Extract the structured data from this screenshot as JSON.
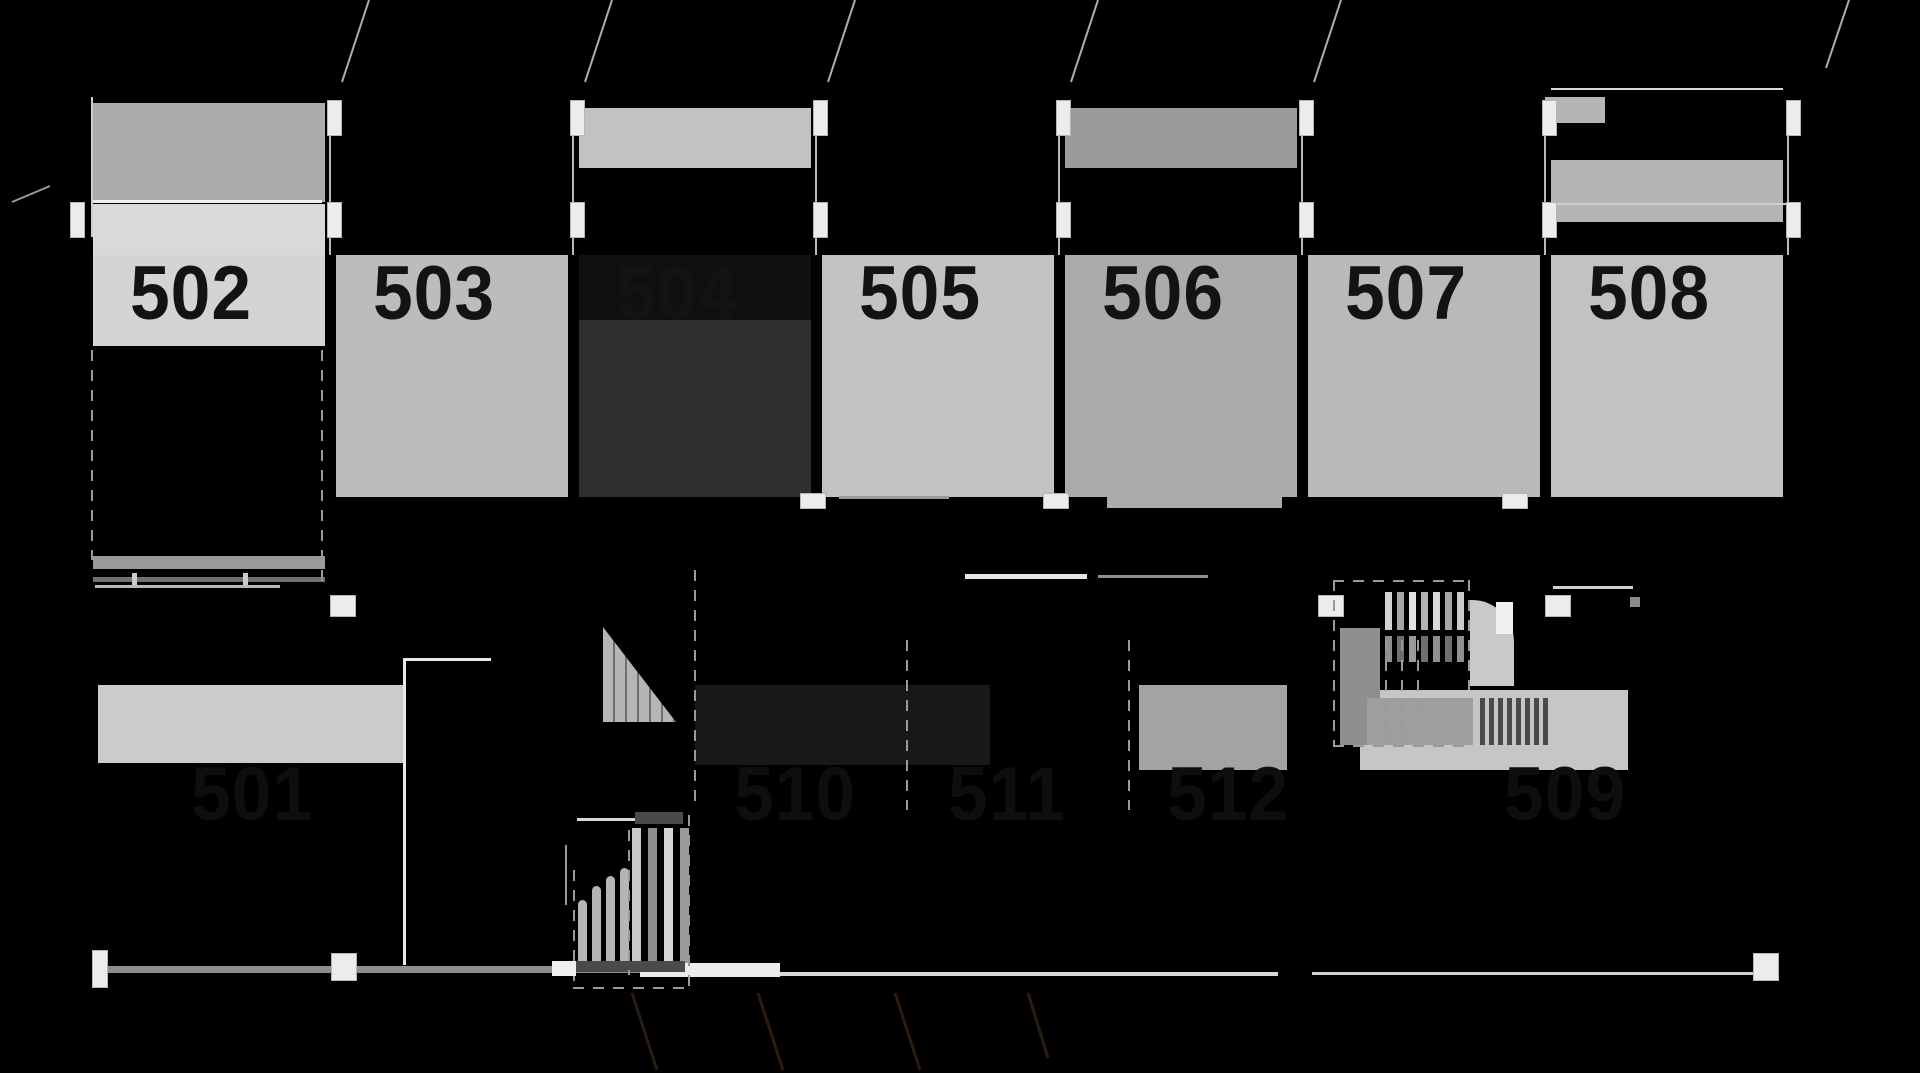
{
  "drawing": {
    "kind": "dark-background architectural floor plan with numbered rooms and stairs",
    "background": "#000000",
    "number_color_top": "#131313",
    "number_color_bottom": "#0e0e0e",
    "room_width": 232,
    "top_number_y": 256,
    "bottom_number_y": 757
  },
  "top_rooms": [
    {
      "number": "502",
      "x": 93,
      "rects": [
        {
          "y": 103,
          "h": 99,
          "c": "#ababab"
        },
        {
          "y": 204,
          "h": 51,
          "c": "#d9d9d9"
        },
        {
          "y": 255,
          "h": 91,
          "c": "#d4d4d4"
        }
      ],
      "dashed_lower": true,
      "bars": [
        {
          "y": 556,
          "h": 13,
          "c": "#9a9a9a"
        },
        {
          "y": 577,
          "h": 5,
          "c": "#707070"
        }
      ]
    },
    {
      "number": "503",
      "x": 336,
      "rects": [
        {
          "y": 255,
          "h": 242,
          "c": "#bcbcbc"
        }
      ]
    },
    {
      "number": "504",
      "x": 579,
      "rects": [
        {
          "y": 108,
          "h": 60,
          "c": "#c2c2c2"
        },
        {
          "y": 255,
          "h": 65,
          "c": "#101010"
        },
        {
          "y": 320,
          "h": 177,
          "c": "#2f2f2f"
        }
      ]
    },
    {
      "number": "505",
      "x": 822,
      "rects": [
        {
          "y": 255,
          "h": 242,
          "c": "#c3c3c3"
        }
      ]
    },
    {
      "number": "506",
      "x": 1065,
      "rects": [
        {
          "y": 108,
          "h": 60,
          "c": "#9b9b9b"
        },
        {
          "y": 255,
          "h": 242,
          "c": "#ababab"
        },
        {
          "dx": 42,
          "y": 497,
          "w": 175,
          "h": 11,
          "c": "#ababab"
        }
      ]
    },
    {
      "number": "507",
      "x": 1308,
      "rects": [
        {
          "y": 255,
          "h": 242,
          "c": "#b9b9b9"
        }
      ]
    },
    {
      "number": "508",
      "x": 1551,
      "rects": [
        {
          "y": 160,
          "h": 62,
          "c": "#b5b5b5"
        },
        {
          "y": 255,
          "h": 242,
          "c": "#c2c2c2"
        }
      ]
    }
  ],
  "bottom_rooms": [
    {
      "number": "501",
      "cx": 252,
      "rects": [
        {
          "x": 98,
          "y": 685,
          "w": 305,
          "h": 78,
          "c": "#cbcbcb"
        }
      ]
    },
    {
      "number": "510",
      "cx": 795,
      "rects": [
        {
          "x": 695,
          "y": 685,
          "w": 295,
          "h": 80,
          "c": "#181818"
        }
      ]
    },
    {
      "number": "511",
      "cx": 1007,
      "rects": []
    },
    {
      "number": "512",
      "cx": 1228,
      "rects": [
        {
          "x": 1139,
          "y": 685,
          "w": 148,
          "h": 85,
          "c": "#a3a3a3"
        }
      ]
    },
    {
      "number": "509",
      "cx": 1565,
      "rects": [
        {
          "x": 1360,
          "y": 690,
          "w": 268,
          "h": 80,
          "c": "#c6c6c6"
        }
      ]
    }
  ],
  "walls": [
    [
      93,
      200,
      229,
      3,
      "#efefef"
    ],
    [
      91,
      97,
      2,
      140,
      "#cfcfcf"
    ],
    [
      329,
      135,
      2,
      120,
      "#b9b9b9"
    ],
    [
      572,
      135,
      2,
      120,
      "#b9b9b9"
    ],
    [
      815,
      135,
      2,
      120,
      "#b9b9b9"
    ],
    [
      1058,
      135,
      2,
      120,
      "#b9b9b9"
    ],
    [
      1301,
      135,
      2,
      120,
      "#b9b9b9"
    ],
    [
      1544,
      135,
      2,
      120,
      "#b9b9b9"
    ],
    [
      1787,
      135,
      2,
      120,
      "#b9b9b9"
    ],
    [
      1551,
      88,
      232,
      2,
      "#d9d9d9"
    ],
    [
      1545,
      203,
      244,
      2,
      "#cfcfcf"
    ],
    [
      1545,
      97,
      60,
      26,
      "#b5b5b5"
    ],
    [
      95,
      585,
      185,
      3,
      "#b9b9b9"
    ],
    [
      132,
      573,
      5,
      12,
      "#cccccc"
    ],
    [
      243,
      573,
      5,
      12,
      "#cccccc"
    ],
    [
      403,
      658,
      3,
      307,
      "#e8e8e8"
    ],
    [
      403,
      658,
      88,
      3,
      "#e8e8e8"
    ],
    [
      965,
      574,
      122,
      5,
      "#e6e6e6"
    ],
    [
      1098,
      575,
      110,
      3,
      "#8f8f8f"
    ],
    [
      839,
      496,
      110,
      3,
      "#9a9a9a"
    ],
    [
      1553,
      586,
      80,
      3,
      "#cfcfcf"
    ],
    [
      100,
      966,
      540,
      7,
      "#8c8c8c"
    ],
    [
      640,
      963,
      140,
      14,
      "#ebebeb"
    ],
    [
      780,
      972,
      498,
      4,
      "#d9d9d9"
    ],
    [
      1312,
      972,
      445,
      3,
      "#cfcfcf"
    ],
    [
      565,
      845,
      2,
      60,
      "#9a9a9a"
    ],
    [
      577,
      818,
      106,
      3,
      "#d9d9d9"
    ],
    [
      1630,
      597,
      10,
      10,
      "#8a8a8a"
    ]
  ],
  "door_markers": [
    [
      327,
      100,
      15,
      36
    ],
    [
      327,
      202,
      15,
      36
    ],
    [
      570,
      100,
      15,
      36
    ],
    [
      570,
      202,
      15,
      36
    ],
    [
      813,
      100,
      15,
      36
    ],
    [
      813,
      202,
      15,
      36
    ],
    [
      1056,
      100,
      15,
      36
    ],
    [
      1056,
      202,
      15,
      36
    ],
    [
      1299,
      100,
      15,
      36
    ],
    [
      1299,
      202,
      15,
      36
    ],
    [
      1542,
      100,
      15,
      36
    ],
    [
      1542,
      202,
      15,
      36
    ],
    [
      70,
      202,
      15,
      36
    ],
    [
      1786,
      100,
      15,
      36
    ],
    [
      1786,
      202,
      15,
      36
    ],
    [
      800,
      493,
      26,
      16
    ],
    [
      1043,
      493,
      26,
      16
    ],
    [
      1502,
      493,
      26,
      16
    ],
    [
      330,
      595,
      26,
      22
    ],
    [
      1318,
      595,
      26,
      22
    ],
    [
      1545,
      595,
      26,
      22
    ],
    [
      92,
      950,
      16,
      38
    ],
    [
      331,
      953,
      26,
      28
    ],
    [
      1753,
      953,
      26,
      28
    ]
  ],
  "dashed_vertical": [
    [
      91,
      350,
      210
    ],
    [
      321,
      350,
      240
    ],
    [
      694,
      570,
      240
    ],
    [
      906,
      640,
      170
    ],
    [
      1128,
      640,
      170
    ]
  ],
  "stair_upper": {
    "outline": [
      1333,
      580,
      135,
      165
    ],
    "treads": {
      "x0": 1385,
      "step": 12,
      "w": 7,
      "y": 592,
      "h": 38,
      "colors": [
        "#d2d2d2",
        "#a6a6a6",
        "#e0e0e0",
        "#b2b2b2",
        "#d8d8d8",
        "#a6a6a6",
        "#cccccc"
      ]
    },
    "treads2": {
      "x0": 1385,
      "step": 12,
      "w": 7,
      "y": 636,
      "h": 26,
      "colors": [
        "#8f8f8f",
        "#6f6f6f",
        "#9a9a9a",
        "#6f6f6f",
        "#8f8f8f",
        "#6f6f6f",
        "#8f8f8f"
      ]
    },
    "left_block": [
      1340,
      628,
      40,
      117,
      "#8f8f8f"
    ],
    "landing": [
      1470,
      600,
      44,
      86,
      "#c9c9c9"
    ],
    "landing_radius": 42,
    "slab": [
      1496,
      602,
      17,
      32,
      "#f0f0f0"
    ],
    "bar": [
      1367,
      698,
      106,
      47,
      "#9e9e9e"
    ],
    "stripes": {
      "x0": 1480,
      "step": 9,
      "w": 5,
      "n": 8,
      "y": 698,
      "h": 47,
      "c": "#4a4a4a"
    },
    "inner_dashes": [
      [
        1385,
        640,
        105
      ],
      [
        1401,
        640,
        105
      ],
      [
        1417,
        640,
        70
      ]
    ]
  },
  "stair_lower": {
    "outline": [
      573,
      815,
      115,
      172
    ],
    "right_treads": {
      "x0": 632,
      "step": 16,
      "w": 9,
      "y": 828,
      "h": 135,
      "colors": [
        "#c9c9c9",
        "#8f8f8f",
        "#d6d6d6",
        "#9a9a9a"
      ]
    },
    "left_treads": [
      [
        578,
        900,
        63
      ],
      [
        592,
        886,
        77
      ],
      [
        606,
        876,
        87
      ],
      [
        620,
        868,
        95
      ]
    ],
    "left_tread_w": 9,
    "left_tread_c": "#b5b5b5",
    "top_bar": [
      635,
      812,
      48,
      12,
      "#4a4a4a"
    ],
    "bottom_bar": [
      575,
      961,
      110,
      11,
      "#4a4a4a"
    ],
    "landing": [
      552,
      961,
      24,
      15,
      "#efefef"
    ],
    "divider_dash": [
      628,
      830,
      145
    ]
  },
  "ramp_triangle": {
    "x": 603,
    "y": 627,
    "w": 73,
    "h": 95
  },
  "diagonals": [
    [
      369,
      0,
      342,
      82,
      "#b4ab9f",
      2
    ],
    [
      612,
      0,
      585,
      82,
      "#b4ab9f",
      2
    ],
    [
      855,
      0,
      828,
      82,
      "#b4ab9f",
      2
    ],
    [
      1098,
      0,
      1071,
      82,
      "#b4ab9f",
      2
    ],
    [
      1341,
      0,
      1314,
      82,
      "#b4ab9f",
      2
    ],
    [
      1849,
      0,
      1826,
      68,
      "#b4ab9f",
      2
    ],
    [
      12,
      202,
      50,
      186,
      "#9a9a9a",
      2
    ],
    [
      632,
      993,
      657,
      1070,
      "#2a1d10",
      3
    ],
    [
      758,
      993,
      783,
      1070,
      "#2a1d10",
      3
    ],
    [
      895,
      993,
      920,
      1070,
      "#2a1d10",
      3
    ],
    [
      1028,
      993,
      1048,
      1058,
      "#2a1d10",
      3
    ]
  ]
}
